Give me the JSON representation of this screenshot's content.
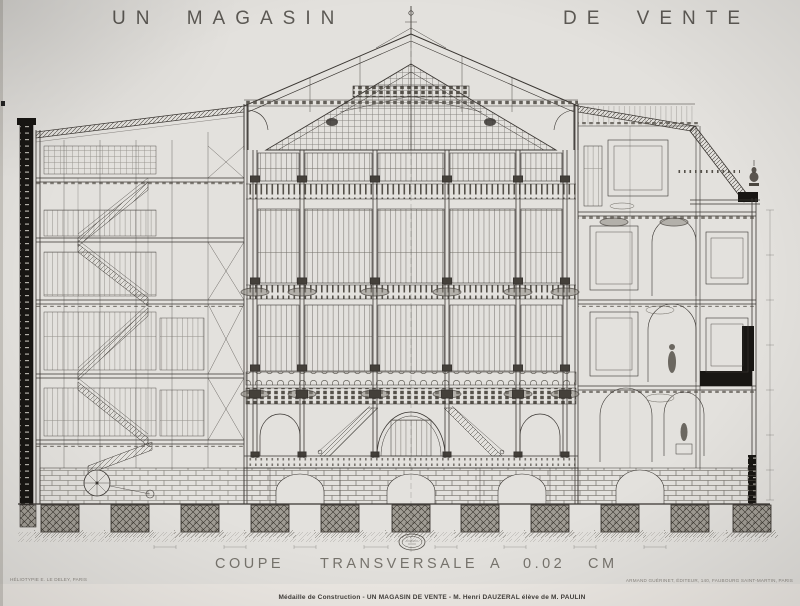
{
  "colors": {
    "paper": "#e3e1dd",
    "ink": "#3a3632",
    "ink_light": "#6b675f",
    "poche_black": "#181613"
  },
  "header": {
    "title_left": "UN MAGASIN",
    "title_right": "DE VENTE"
  },
  "footer": {
    "scale_words": [
      "COUPE",
      "TRANSVERSALE",
      "A",
      "0.02",
      "CM"
    ],
    "scale_caption_full": "COUPE TRANSVERSALE A 0.02 CM",
    "credit_line": "Médaille de Construction - UN MAGASIN DE VENTE - M. Henri DAUZERAL élève de M. PAULIN",
    "imprint_left": "HÉLIOTYPIE E. LE DELEY, PARIS",
    "imprint_right": "ARMAND GUÉRINET, ÉDITEUR, 140, FAUBOURG SAINT-MARTIN, PARIS"
  }
}
